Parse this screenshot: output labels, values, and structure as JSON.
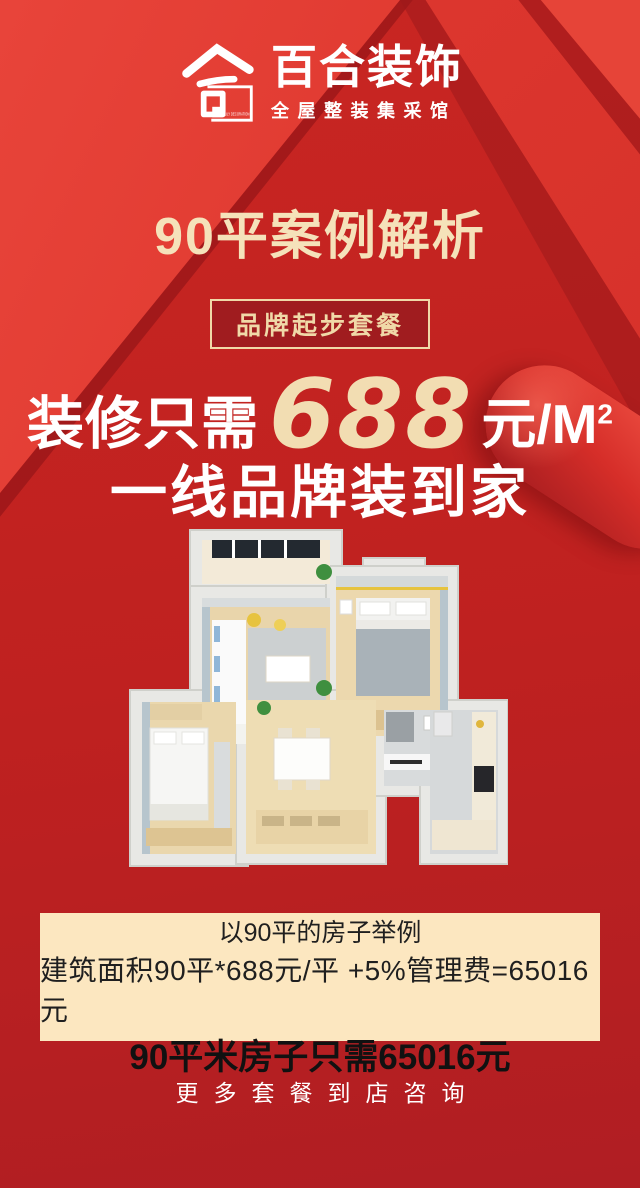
{
  "brand": {
    "name": "百合装饰",
    "tagline": "全屋整装集采馆",
    "logo_caption": "LILY DECORATION"
  },
  "title": "90平案例解析",
  "badge": "品牌起步套餐",
  "offer": {
    "prefix": "装修只需",
    "price": "688",
    "unit": "元/M",
    "unit_sup": "2",
    "tagline": "一线品牌装到家"
  },
  "example": {
    "line1": "以90平的房子举例",
    "line2": "建筑面积90平*688元/平 +5%管理费=65016元",
    "line3": "90平米房子只需65016元"
  },
  "footer_cta": "更多套餐到店咨询",
  "colors": {
    "base_red": "#bf2120",
    "bright_red": "#e8443a",
    "deep_red": "#a01c1f",
    "gold_text": "#f2ddb2",
    "cream_panel": "#fce7c0",
    "badge_border": "#f0d9a8",
    "dark_text": "#1f1f1f",
    "white": "#ffffff"
  }
}
